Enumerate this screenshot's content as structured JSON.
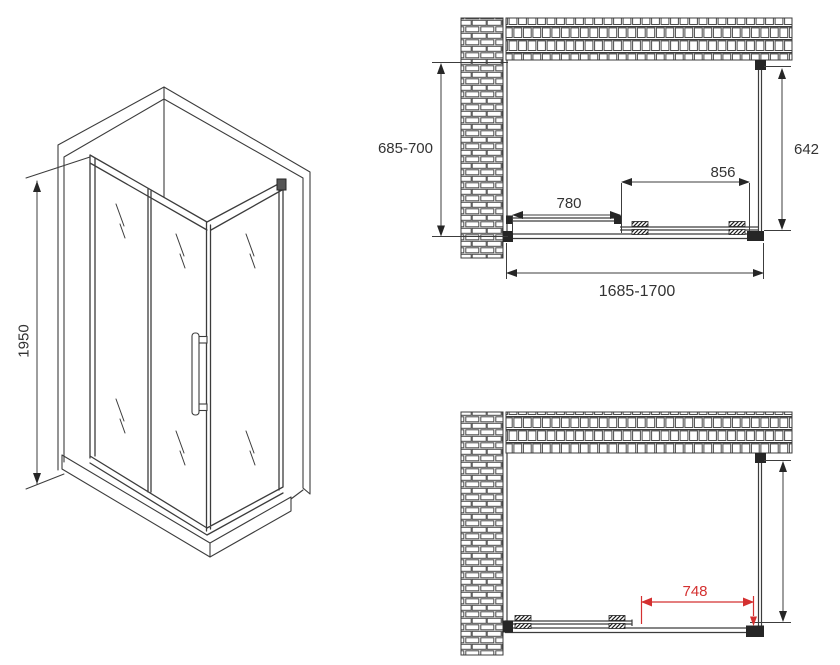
{
  "drawing": {
    "type": "shower-enclosure-technical-drawing",
    "colors": {
      "line": "#3c3c3c",
      "dark": "#262626",
      "accent_red": "#d43030",
      "text": "#333333",
      "background": "#ffffff"
    },
    "isometric_view": {
      "height_label": "1950"
    },
    "top_plan_view": {
      "wall_depth_label": "685-700",
      "side_panel_label": "642",
      "door_panel_label": "856",
      "fixed_panel_label": "780",
      "total_width_label": "1685-1700"
    },
    "bottom_plan_view": {
      "opening_label": "748"
    }
  }
}
